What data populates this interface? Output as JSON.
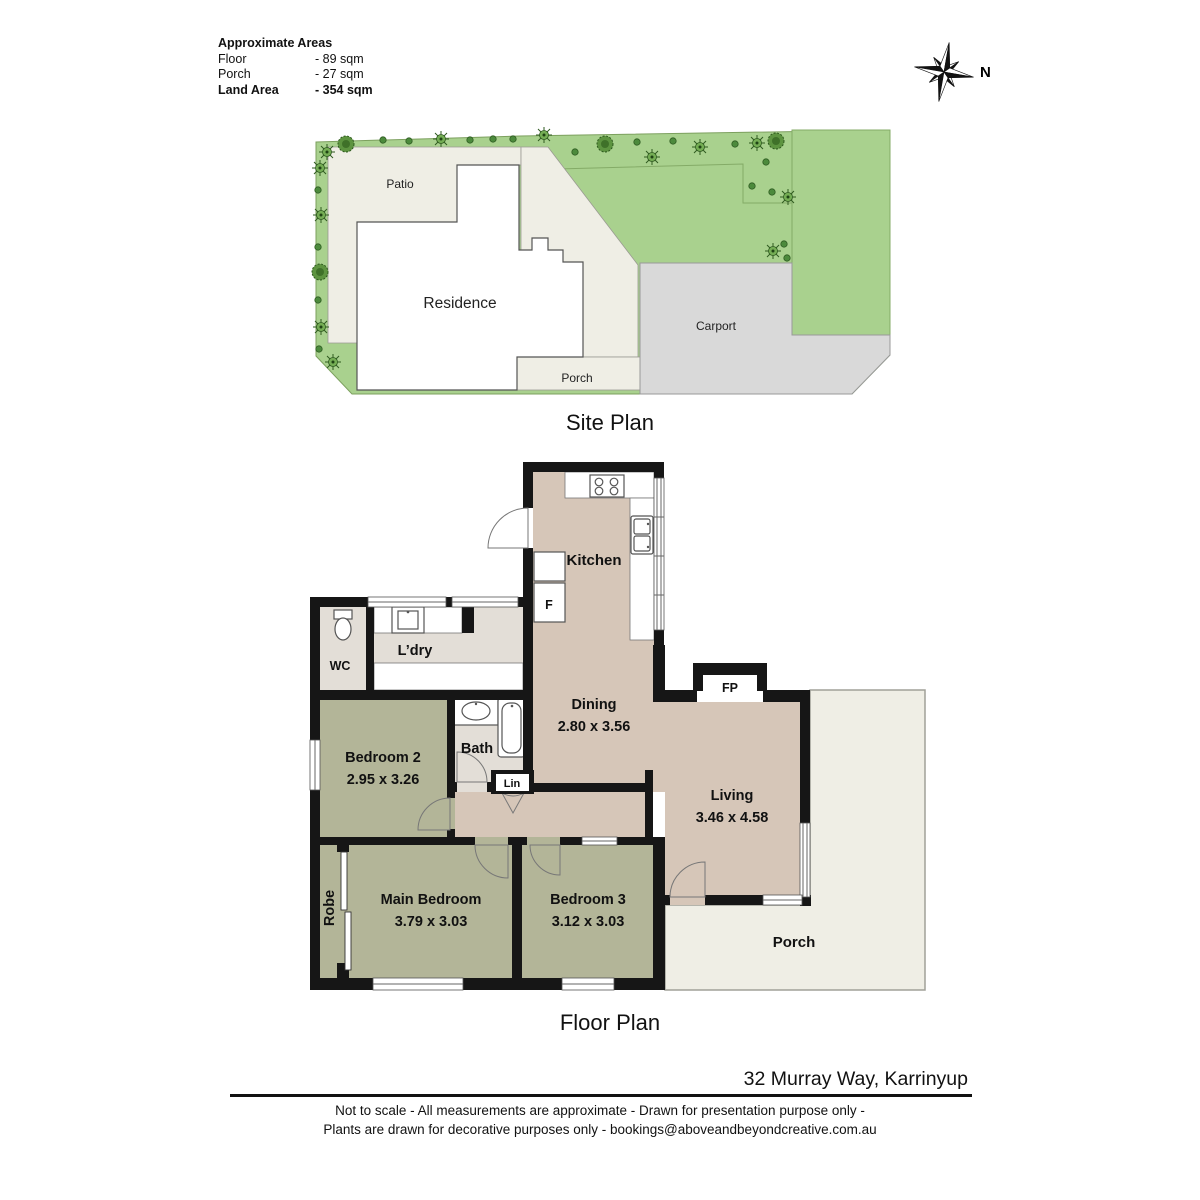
{
  "areas_panel": {
    "title": "Approximate Areas",
    "rows": [
      {
        "label": "Floor",
        "value": "- 89 sqm"
      },
      {
        "label": "Porch",
        "value": "- 27 sqm"
      },
      {
        "label": "Land Area",
        "value": "- 354 sqm"
      }
    ]
  },
  "compass": {
    "north_label": "N"
  },
  "site_plan": {
    "title": "Site Plan",
    "labels": {
      "patio": "Patio",
      "residence": "Residence",
      "porch": "Porch",
      "carport": "Carport"
    }
  },
  "floor_plan": {
    "title": "Floor Plan",
    "labels": {
      "kitchen": "Kitchen",
      "fridge": "F",
      "wc": "WC",
      "laundry": "L’dry",
      "dining_name": "Dining",
      "dining_dims": "2.80 x 3.56",
      "fireplace": "FP",
      "bedroom2_name": "Bedroom 2",
      "bedroom2_dims": "2.95 x 3.26",
      "bath": "Bath",
      "linen": "Lin",
      "living_name": "Living",
      "living_dims": "3.46 x 4.58",
      "robe": "Robe",
      "main_bedroom_name": "Main Bedroom",
      "main_bedroom_dims": "3.79 x 3.03",
      "bedroom3_name": "Bedroom 3",
      "bedroom3_dims": "3.12 x 3.03",
      "porch": "Porch"
    }
  },
  "footer": {
    "address": "32 Murray Way, Karrinyup",
    "disclaimer_line1": "Not to scale - All measurements are approximate - Drawn for presentation purpose only -",
    "disclaimer_line2": "Plants are drawn for decorative purposes only - bookings@aboveandbeyondcreative.com.au"
  },
  "palette": {
    "floor_tan": "#d6c6b8",
    "bedroom_sage": "#b3b598",
    "wet_area_grey": "#e3ded7",
    "porch_cream": "#efeee5",
    "lawn_green": "#a9d18e",
    "carport_grey": "#d9d9d9",
    "wall_black": "#161616"
  }
}
